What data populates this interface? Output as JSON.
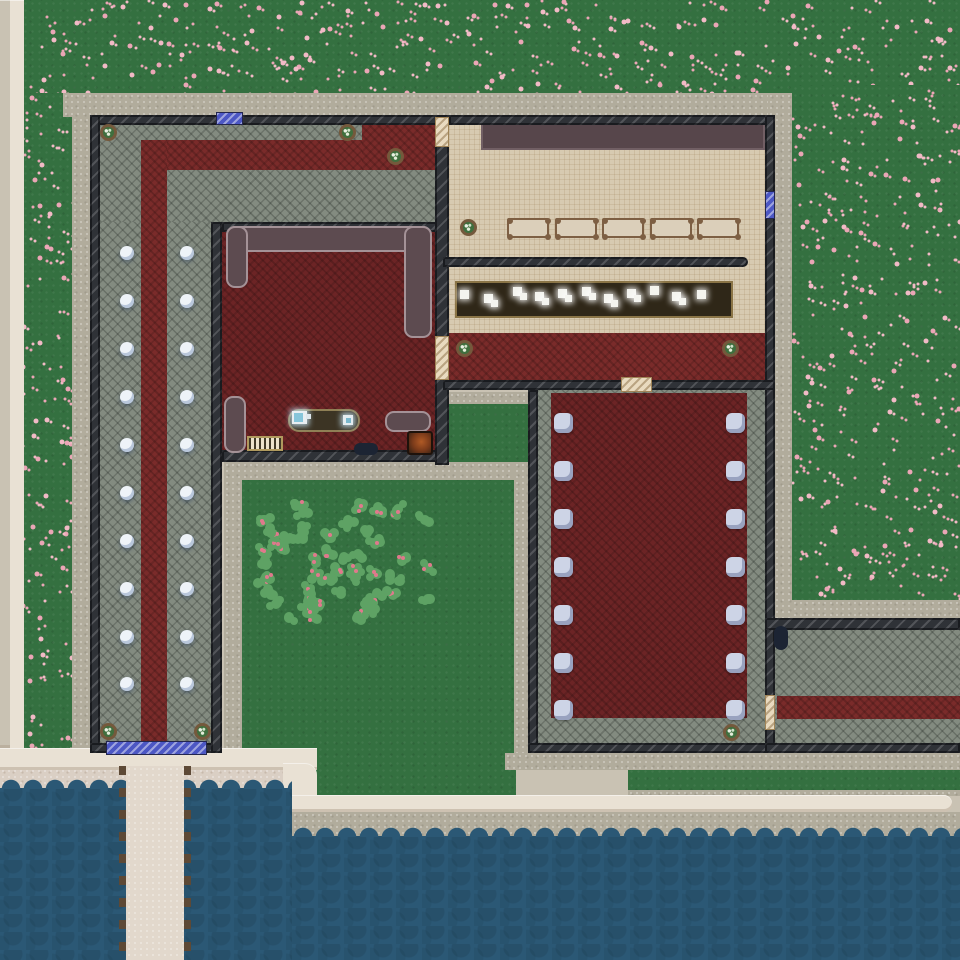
{
  "scene": {
    "colors": {
      "grass": "#347040",
      "flower1": "#f2bac6",
      "flower2": "#eba6b6",
      "path": "#b1ac9c",
      "road": "#e9e1d4",
      "curb": "#c9c2b3",
      "sand": "#dacfc4",
      "water": "#2b5875",
      "wall": "#2f3237",
      "stone": "#838b80",
      "tile": "#d7cab1",
      "carpet": "#7a2b2a",
      "carpet2": "#6c2425",
      "stage": "#57464b",
      "sofa": "#5d4b50",
      "jail_door": "#4c57c4",
      "wood_door": "#e9dabf",
      "lamp": "#eef3f8",
      "chair": "#cdd4e6",
      "pier": "#e2d8cc",
      "pier_post": "#5d4936",
      "counter": "#2f2718",
      "table_top": "#dbcfba",
      "plant_pot": "#74593c",
      "plant_leaf": "#3f6f3e",
      "bush": "#5ea264",
      "berry": "#e0798c",
      "tv_screen": "#86c5da",
      "dark_item": "#1c2433"
    },
    "terrain": [
      {
        "name": "grass-north",
        "x": 22,
        "y": 0,
        "w": 938,
        "h": 117,
        "flowers": true
      },
      {
        "name": "grass-east-field",
        "x": 792,
        "y": 85,
        "w": 168,
        "h": 515,
        "flowers": true
      },
      {
        "name": "grass-west-strip",
        "x": 22,
        "y": 93,
        "w": 52,
        "h": 657,
        "flowers": true
      },
      {
        "name": "grass-courtyard",
        "x": 240,
        "y": 480,
        "w": 276,
        "h": 315,
        "flowers": false
      },
      {
        "name": "grass-canteen-pocket",
        "x": 443,
        "y": 404,
        "w": 85,
        "h": 58,
        "flowers": false
      },
      {
        "name": "grass-shore-strip",
        "x": 628,
        "y": 768,
        "w": 332,
        "h": 22,
        "flowers": false
      }
    ],
    "sand": [
      {
        "name": "beach",
        "x": 0,
        "y": 768,
        "w": 292,
        "h": 32
      }
    ],
    "paths": [
      {
        "name": "path-north",
        "x": 63,
        "y": 93,
        "w": 729,
        "h": 24
      },
      {
        "name": "path-west",
        "x": 72,
        "y": 117,
        "w": 18,
        "h": 633
      },
      {
        "name": "path-east",
        "x": 768,
        "y": 93,
        "w": 24,
        "h": 529
      },
      {
        "name": "path-southeast",
        "x": 792,
        "y": 600,
        "w": 168,
        "h": 22
      },
      {
        "name": "path-courtyard-west",
        "x": 224,
        "y": 462,
        "w": 18,
        "h": 288
      },
      {
        "name": "path-courtyard-north",
        "x": 224,
        "y": 462,
        "w": 308,
        "h": 18
      },
      {
        "name": "path-courtyard-east",
        "x": 514,
        "y": 462,
        "w": 18,
        "h": 291
      },
      {
        "name": "path-canteen-south",
        "x": 443,
        "y": 392,
        "w": 85,
        "h": 12
      },
      {
        "name": "path-buildings-south",
        "x": 505,
        "y": 753,
        "w": 455,
        "h": 17
      },
      {
        "name": "path-shore-thin",
        "x": 628,
        "y": 790,
        "w": 332,
        "h": 6
      },
      {
        "name": "quay",
        "x": 292,
        "y": 812,
        "w": 668,
        "h": 26
      }
    ],
    "roads": [
      {
        "name": "curb-west",
        "x": 0,
        "y": 0,
        "w": 10,
        "h": 748,
        "curb": true
      },
      {
        "name": "road-west",
        "x": 10,
        "y": 0,
        "w": 14,
        "h": 770
      },
      {
        "name": "road-south-upper",
        "x": 0,
        "y": 748,
        "w": 317,
        "h": 22
      },
      {
        "name": "road-step",
        "x": 283,
        "y": 763,
        "w": 34,
        "h": 49,
        "radius": "0 12px 0 0"
      },
      {
        "name": "road-south-lower",
        "x": 292,
        "y": 795,
        "w": 660,
        "h": 17,
        "radius": "0 8px 8px 0"
      }
    ],
    "water": [
      {
        "name": "water-southwest",
        "x": 0,
        "y": 788,
        "w": 292,
        "h": 172
      },
      {
        "name": "water-south",
        "x": 292,
        "y": 836,
        "w": 668,
        "h": 124
      }
    ],
    "pier": {
      "name": "pier",
      "x": 119,
      "y": 766,
      "w": 72,
      "h": 194
    },
    "floors": [
      {
        "name": "floor-admin",
        "type": "stone",
        "x": 100,
        "y": 125,
        "w": 335,
        "h": 97
      },
      {
        "name": "floor-corridor",
        "type": "stone",
        "x": 100,
        "y": 222,
        "w": 111,
        "h": 521
      },
      {
        "name": "carpet-admin-run",
        "type": "carpet",
        "x": 142,
        "y": 140,
        "w": 293,
        "h": 30
      },
      {
        "name": "carpet-admin-ext",
        "type": "carpet",
        "x": 362,
        "y": 125,
        "w": 73,
        "h": 45
      },
      {
        "name": "carpet-corridor",
        "type": "carpet",
        "x": 141,
        "y": 140,
        "w": 26,
        "h": 603
      },
      {
        "name": "floor-lounge",
        "type": "carpet2",
        "x": 222,
        "y": 232,
        "w": 213,
        "h": 218
      },
      {
        "name": "floor-canteen",
        "type": "tile",
        "x": 449,
        "y": 125,
        "w": 316,
        "h": 255
      },
      {
        "name": "stage",
        "type": "stage",
        "x": 481,
        "y": 123,
        "w": 284,
        "h": 27
      },
      {
        "name": "carpet-canteen",
        "type": "carpet",
        "x": 449,
        "y": 333,
        "w": 316,
        "h": 47
      },
      {
        "name": "floor-chapel",
        "type": "stone",
        "x": 538,
        "y": 390,
        "w": 227,
        "h": 353
      },
      {
        "name": "carpet-chapel",
        "type": "carpet2",
        "x": 551,
        "y": 393,
        "w": 196,
        "h": 325
      },
      {
        "name": "floor-east-room",
        "type": "stone",
        "x": 775,
        "y": 630,
        "w": 185,
        "h": 113
      },
      {
        "name": "carpet-east-room",
        "type": "carpet",
        "x": 777,
        "y": 696,
        "w": 183,
        "h": 23
      }
    ],
    "walls": [
      {
        "name": "wall-b1-north",
        "x": 90,
        "y": 115,
        "w": 359,
        "h": 10
      },
      {
        "name": "wall-b1-west",
        "x": 90,
        "y": 115,
        "w": 10,
        "h": 638
      },
      {
        "name": "wall-b1-south",
        "x": 90,
        "y": 743,
        "w": 132,
        "h": 10
      },
      {
        "name": "wall-corridor-east",
        "x": 211,
        "y": 222,
        "w": 11,
        "h": 531
      },
      {
        "name": "wall-lounge-north",
        "x": 222,
        "y": 222,
        "w": 227,
        "h": 10
      },
      {
        "name": "wall-lounge-south",
        "x": 222,
        "y": 450,
        "w": 227,
        "h": 12
      },
      {
        "name": "wall-canteen-west",
        "x": 435,
        "y": 115,
        "w": 14,
        "h": 350
      },
      {
        "name": "wall-canteen-north",
        "x": 449,
        "y": 115,
        "w": 326,
        "h": 10
      },
      {
        "name": "wall-east",
        "x": 765,
        "y": 115,
        "w": 10,
        "h": 638
      },
      {
        "name": "wall-canteen-divider",
        "x": 443,
        "y": 257,
        "w": 305,
        "h": 10,
        "radius": "0 5px 5px 0"
      },
      {
        "name": "wall-canteen-south",
        "x": 443,
        "y": 380,
        "w": 332,
        "h": 10
      },
      {
        "name": "wall-chapel-west",
        "x": 528,
        "y": 390,
        "w": 10,
        "h": 363
      },
      {
        "name": "wall-chapel-south",
        "x": 528,
        "y": 743,
        "w": 247,
        "h": 10
      },
      {
        "name": "wall-east-room-north",
        "x": 765,
        "y": 618,
        "w": 195,
        "h": 12
      },
      {
        "name": "wall-east-room-south",
        "x": 765,
        "y": 743,
        "w": 195,
        "h": 10
      }
    ],
    "doors": [
      {
        "name": "jail-door-north",
        "type": "jail",
        "x": 216,
        "y": 112,
        "w": 27,
        "h": 13
      },
      {
        "name": "jail-door-corridor-south",
        "type": "jail",
        "x": 106,
        "y": 741,
        "w": 101,
        "h": 14
      },
      {
        "name": "jail-door-canteen-east",
        "type": "jail",
        "x": 765,
        "y": 191,
        "w": 10,
        "h": 28
      },
      {
        "name": "wood-door-admin-canteen",
        "type": "wood",
        "x": 435,
        "y": 117,
        "w": 14,
        "h": 30
      },
      {
        "name": "wood-door-lounge-canteen",
        "type": "wood",
        "x": 435,
        "y": 336,
        "w": 14,
        "h": 44
      },
      {
        "name": "wood-door-canteen-chapel",
        "type": "wood",
        "x": 621,
        "y": 377,
        "w": 31,
        "h": 15
      },
      {
        "name": "wood-door-chapel-east-room",
        "type": "wood",
        "x": 765,
        "y": 695,
        "w": 10,
        "h": 35
      }
    ],
    "lamps": {
      "columns": [
        127,
        187
      ],
      "rows": [
        253,
        301,
        349,
        397,
        445,
        493,
        541,
        589,
        637,
        684
      ],
      "radius": 7
    },
    "chairs": {
      "left_x": 554,
      "right_x": 726,
      "rows": [
        413,
        461,
        509,
        557,
        605,
        653,
        700
      ],
      "w": 19,
      "h": 20
    },
    "plants": [
      [
        108,
        132
      ],
      [
        347,
        132
      ],
      [
        395,
        156
      ],
      [
        468,
        227
      ],
      [
        464,
        348
      ],
      [
        730,
        348
      ],
      [
        108,
        731
      ],
      [
        202,
        731
      ],
      [
        731,
        732
      ]
    ],
    "dining_tables": {
      "y": 218,
      "w": 42,
      "h": 20,
      "xs": [
        507,
        555,
        602,
        650,
        697
      ]
    },
    "serving_counter": {
      "x": 455,
      "y": 281,
      "w": 278,
      "h": 37,
      "trays": [
        [
          460,
          290
        ],
        [
          484,
          294
        ],
        [
          513,
          287
        ],
        [
          535,
          292
        ],
        [
          558,
          289
        ],
        [
          582,
          287
        ],
        [
          604,
          294
        ],
        [
          627,
          289
        ],
        [
          650,
          286
        ],
        [
          672,
          292
        ],
        [
          697,
          290
        ]
      ]
    },
    "sofas": [
      {
        "name": "sofa-top",
        "x": 226,
        "y": 226,
        "w": 206,
        "h": 26
      },
      {
        "name": "sofa-left-arm",
        "x": 226,
        "y": 226,
        "w": 22,
        "h": 62
      },
      {
        "name": "sofa-right-arm",
        "x": 404,
        "y": 226,
        "w": 28,
        "h": 112
      },
      {
        "name": "sofa-bottom-left",
        "x": 224,
        "y": 396,
        "w": 22,
        "h": 57
      },
      {
        "name": "sofa-bottom-right",
        "x": 385,
        "y": 411,
        "w": 46,
        "h": 21
      }
    ],
    "lounge_items": {
      "tv_table": {
        "x": 288,
        "y": 409,
        "w": 72,
        "h": 23
      },
      "tv": {
        "x": 292,
        "y": 411,
        "w": 15,
        "h": 13
      },
      "radio": {
        "x": 343,
        "y": 415,
        "w": 10,
        "h": 10
      },
      "radiator": {
        "x": 247,
        "y": 436,
        "w": 36,
        "h": 15
      },
      "dark_pill": {
        "x": 354,
        "y": 443,
        "w": 24,
        "h": 12
      },
      "fire_box": {
        "x": 407,
        "y": 431,
        "w": 26,
        "h": 24
      }
    },
    "east_room_bin": {
      "x": 774,
      "y": 626,
      "w": 14,
      "h": 24
    },
    "garden": {
      "x": 258,
      "y": 500,
      "w": 177,
      "h": 127,
      "bush_count": 58
    },
    "flower_density": 0.0042,
    "seed": 42
  }
}
